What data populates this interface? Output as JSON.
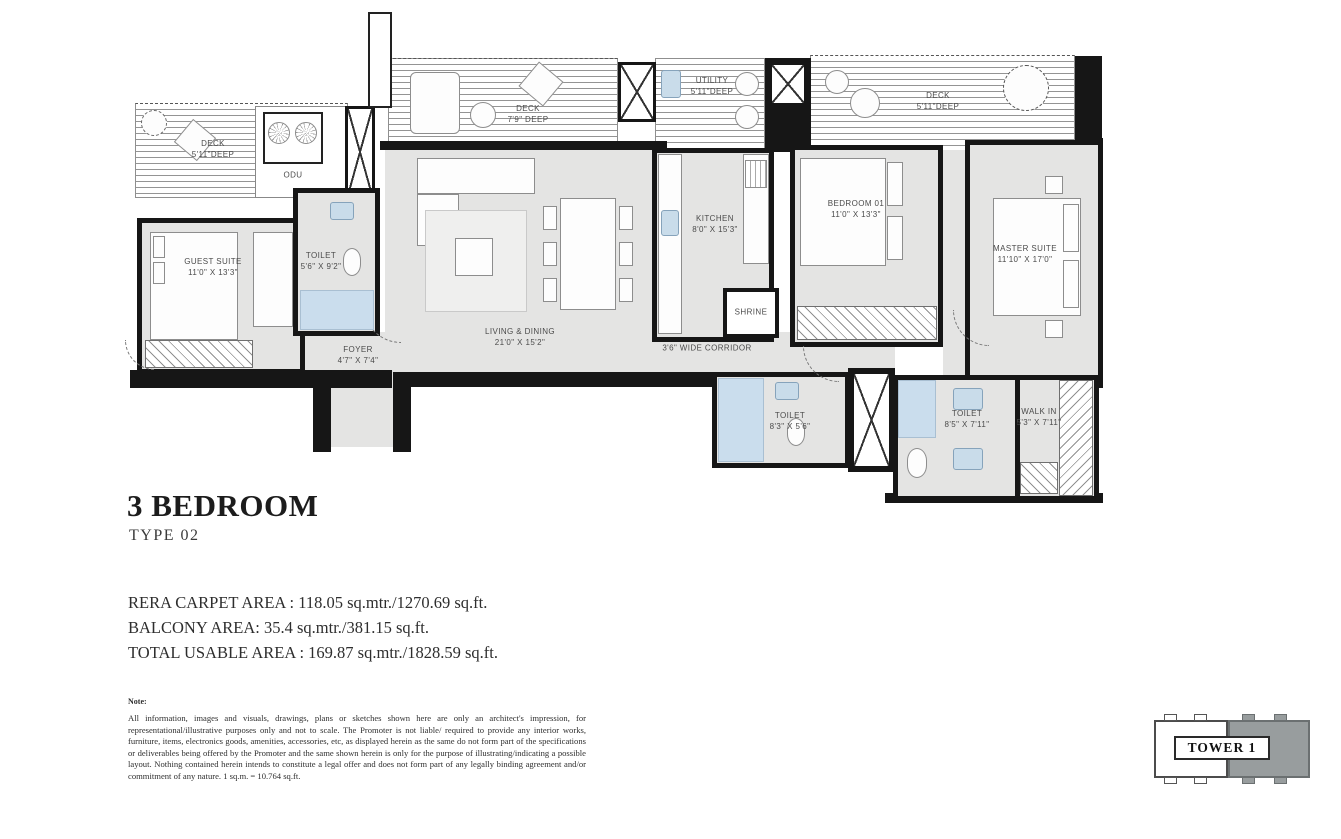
{
  "title": {
    "heading": "3 BEDROOM",
    "subheading": "TYPE 02"
  },
  "areas": {
    "rera": "RERA CARPET AREA : 118.05 sq.mtr./1270.69 sq.ft.",
    "balcony": "BALCONY AREA: 35.4 sq.mtr./381.15 sq.ft.",
    "total": "TOTAL USABLE AREA : 169.87 sq.mtr./1828.59 sq.ft."
  },
  "note": {
    "label": "Note:",
    "text": "All information, images and visuals, drawings, plans or sketches shown here are only an architect's impression, for representational/illustrative purposes only and not to scale. The Promoter is not liable/ required to provide any interior works, furniture, items, electronics goods, amenities, accessories, etc, as displayed herein as the same do not form part of the specifications or deliverables being offered by the Promoter and the same shown herein is only for the purpose of illustrating/indicating a possible layout. Nothing contained herein intends to constitute a legal offer and does not form part of any legally binding agreement and/or commitment of any nature. 1 sq.m. = 10.764 sq.ft."
  },
  "keyplan": {
    "label": "TOWER 1"
  },
  "colors": {
    "wall": "#161616",
    "floor": "#e4e4e3",
    "wet_fixture": "#c9dcea",
    "keyplan_highlight": "#989d9e"
  },
  "rooms": [
    {
      "name": "DECK",
      "dims": "5'11\"DEEP"
    },
    {
      "name": "ODU",
      "dims": ""
    },
    {
      "name": "DECK",
      "dims": "7'9\" DEEP"
    },
    {
      "name": "UTILITY",
      "dims": "5'11\"DEEP"
    },
    {
      "name": "DECK",
      "dims": "5'11\"DEEP"
    },
    {
      "name": "GUEST SUITE",
      "dims": "11'0\" X 13'3\""
    },
    {
      "name": "TOILET",
      "dims": "5'6\" X 9'2\""
    },
    {
      "name": "FOYER",
      "dims": "4'7\" X 7'4\""
    },
    {
      "name": "LIVING & DINING",
      "dims": "21'0\" X 15'2\""
    },
    {
      "name": "KITCHEN",
      "dims": "8'0\" X 15'3\""
    },
    {
      "name": "SHRINE",
      "dims": ""
    },
    {
      "name": "3'6\" WIDE CORRIDOR",
      "dims": ""
    },
    {
      "name": "BEDROOM 01",
      "dims": "11'0\" X 13'3\""
    },
    {
      "name": "MASTER SUITE",
      "dims": "11'10\" X 17'0\""
    },
    {
      "name": "TOILET",
      "dims": "8'3\" X 5'6\""
    },
    {
      "name": "TOILET",
      "dims": "8'5\" X 7'11\""
    },
    {
      "name": "WALK IN",
      "dims": "5'3\" X 7'11\""
    }
  ]
}
